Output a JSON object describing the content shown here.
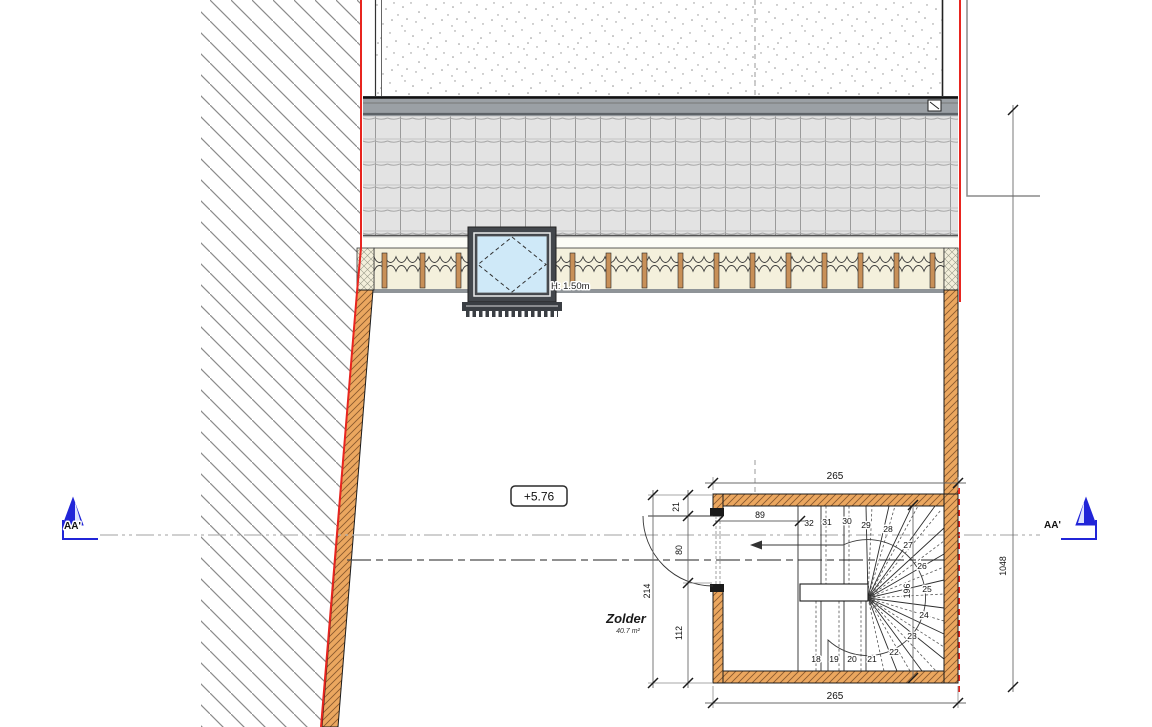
{
  "drawing": {
    "level_label": "+5.76",
    "skylight_note": "H: 1.50m",
    "room": {
      "name": "Zolder",
      "area": "40.7 m²"
    },
    "section_markers": {
      "left": "AA'",
      "right": "AA'"
    },
    "dimensions": {
      "stair_width_top": "265",
      "stair_width_bottom": "265",
      "landing_depth": "89",
      "stair_run_right": "196",
      "door_offset": "21",
      "door_width": "80",
      "wall_segment": "112",
      "stair_total_depth": "214",
      "building_depth_right": "1048"
    },
    "stair": {
      "tread_numbers": [
        "18",
        "19",
        "20",
        "21",
        "22",
        "23",
        "24",
        "25",
        "26",
        "27",
        "28",
        "29",
        "30",
        "31",
        "32"
      ]
    },
    "colors": {
      "accent_red": "#e8251f",
      "section_blue": "#2125d8",
      "wood": "#eba75f",
      "glass": "#cfe9f8"
    }
  }
}
